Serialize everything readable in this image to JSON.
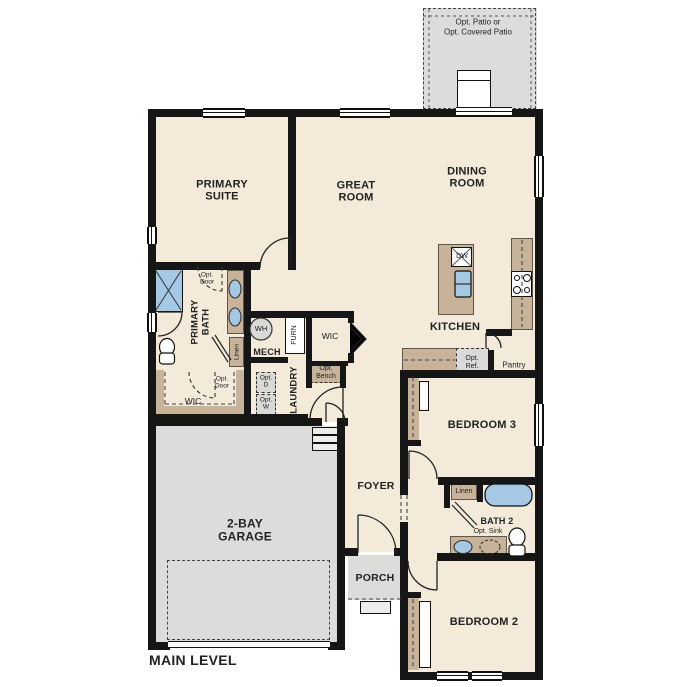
{
  "plan_title": "MAIN LEVEL",
  "rooms": {
    "primary_suite": "PRIMARY SUITE",
    "great_room": "GREAT ROOM",
    "dining_room": "DINING ROOM",
    "kitchen": "KITCHEN",
    "primary_bath": "PRIMARY BATH",
    "mech": "MECH",
    "laundry": "LAUNDRY",
    "wic_primary": "WIC",
    "wic_hall": "WIC",
    "bedroom3": "BEDROOM 3",
    "bedroom2": "BEDROOM 2",
    "bath2": "BATH 2",
    "foyer": "FOYER",
    "porch": "PORCH",
    "garage": "2-BAY GARAGE",
    "pantry": "Pantry"
  },
  "labels": {
    "opt_patio_line1": "Opt. Patio or",
    "opt_patio_line2": "Opt. Covered Patio",
    "opt_door": "Opt. Door",
    "opt_bench": "Opt. Bench",
    "opt_dryer": "Opt. D",
    "opt_washer": "Opt. W",
    "opt_ref": "Opt. Ref.",
    "opt_sink": "Opt. Sink",
    "linen": "Linen",
    "water_heater": "WH",
    "furnace": "FURN",
    "dishwasher": "DW"
  },
  "colors": {
    "floor": "#f4ead9",
    "structure_grey": "#dcdcda",
    "cabinet_tan": "#c7b29a",
    "fixture_blue": "#a5c9e4",
    "wall": "#161616"
  }
}
